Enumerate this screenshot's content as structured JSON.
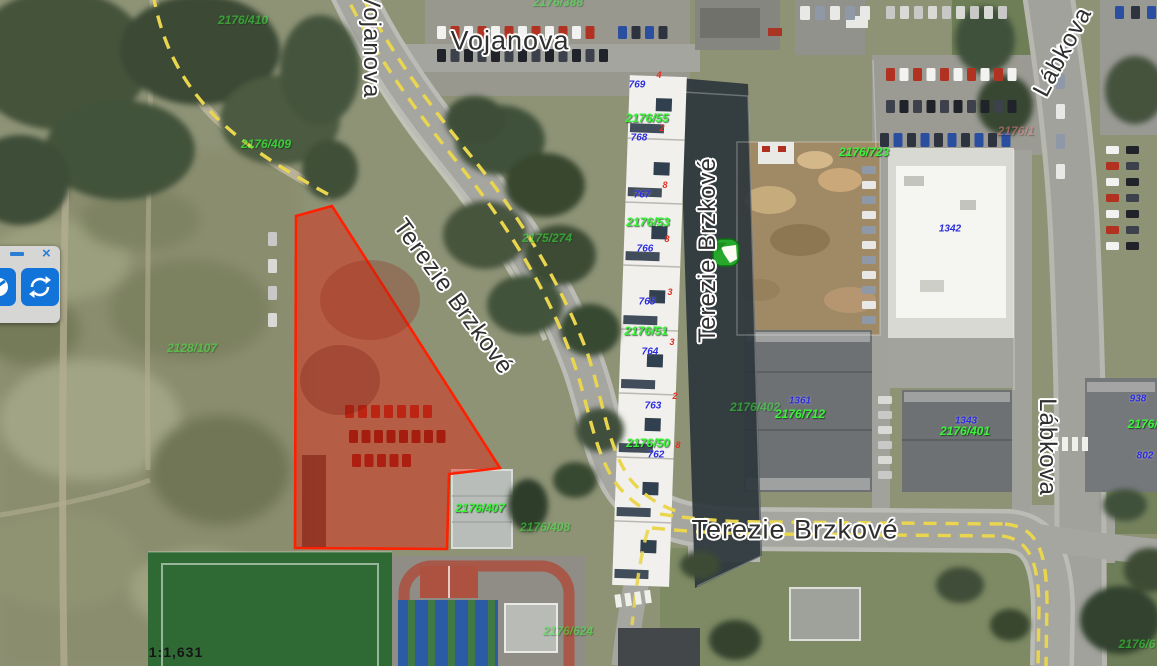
{
  "app": {
    "type": "aerial-map-viewer"
  },
  "colors": {
    "selection_red": "#ff2000",
    "parcel_green": "#3bf23b",
    "house_number_blue": "#2b2bdf",
    "orientation_red": "#e03024",
    "toolbar_blue": "#1273d8",
    "road_dash_yellow": "#ead64e",
    "marker_green": "#27a82c"
  },
  "toolbar": {
    "minimize_label": "–",
    "close_label": "×",
    "buttons": [
      {
        "name": "toolbar-button-partial",
        "icon": "partial-globe-icon"
      },
      {
        "name": "refresh-button",
        "icon": "refresh-icon"
      }
    ]
  },
  "marker": {
    "name": "map-marker",
    "x": 712,
    "y": 238
  },
  "map": {
    "scale_label": "1:1,631",
    "labels": [
      {
        "name": "street-label-vojanova-vertical",
        "text": "Vojanova",
        "x": 371,
        "y": 45,
        "rot": 90,
        "cls": "street"
      },
      {
        "name": "street-label-vojanova",
        "text": "Vojanova",
        "x": 510,
        "y": 41,
        "rot": 0,
        "cls": "street",
        "fs": 27
      },
      {
        "name": "street-label-terezie-brzkove-diagonal",
        "text": "Terezie Brzkové",
        "x": 453,
        "y": 297,
        "rot": 54,
        "cls": "street"
      },
      {
        "name": "street-label-terezie-brzkove-vertical",
        "text": "Terezie Brzkové",
        "x": 708,
        "y": 250,
        "rot": -90,
        "cls": "street"
      },
      {
        "name": "street-label-terezie-brzkove",
        "text": "Terezie Brzkové",
        "x": 795,
        "y": 530,
        "rot": 0,
        "cls": "street",
        "fs": 27
      },
      {
        "name": "street-label-labkova-top",
        "text": "Lábkova",
        "x": 1063,
        "y": 52,
        "rot": -62,
        "cls": "street"
      },
      {
        "name": "street-label-labkova",
        "text": "Lábkova",
        "x": 1047,
        "y": 447,
        "rot": 90,
        "cls": "street"
      },
      {
        "name": "parcel-label",
        "text": "2176/410",
        "x": 243,
        "y": 20,
        "cls": "parcel faint"
      },
      {
        "name": "parcel-label",
        "text": "2176/409",
        "x": 266,
        "y": 144,
        "cls": "parcel dim"
      },
      {
        "name": "parcel-label",
        "text": "2176/388",
        "x": 558,
        "y": 2,
        "cls": "parcel faint"
      },
      {
        "name": "parcel-label",
        "text": "2175/274",
        "x": 547,
        "y": 238,
        "cls": "parcel faint"
      },
      {
        "name": "parcel-label",
        "text": "2176/55",
        "x": 647,
        "y": 118,
        "cls": "parcel"
      },
      {
        "name": "parcel-label",
        "text": "2176/53",
        "x": 648,
        "y": 222,
        "cls": "parcel"
      },
      {
        "name": "parcel-label",
        "text": "2176/51",
        "x": 646,
        "y": 331,
        "cls": "parcel"
      },
      {
        "name": "parcel-label",
        "text": "2176/50",
        "x": 648,
        "y": 443,
        "cls": "parcel"
      },
      {
        "name": "parcel-label",
        "text": "2176/407",
        "x": 480,
        "y": 508,
        "cls": "parcel"
      },
      {
        "name": "parcel-label",
        "text": "2176/408",
        "x": 545,
        "y": 527,
        "cls": "parcel faint"
      },
      {
        "name": "parcel-label",
        "text": "2176/402",
        "x": 755,
        "y": 407,
        "cls": "parcel faint"
      },
      {
        "name": "parcel-label",
        "text": "2176/712",
        "x": 800,
        "y": 414,
        "cls": "parcel"
      },
      {
        "name": "parcel-label",
        "text": "2176/723",
        "x": 864,
        "y": 152,
        "cls": "parcel"
      },
      {
        "name": "parcel-label",
        "text": "2176/401",
        "x": 965,
        "y": 431,
        "cls": "parcel"
      },
      {
        "name": "parcel-label",
        "text": "2128/107",
        "x": 192,
        "y": 348,
        "cls": "parcel faint"
      },
      {
        "name": "parcel-label",
        "text": "2176/624",
        "x": 568,
        "y": 631,
        "cls": "parcel faint"
      },
      {
        "name": "parcel-label",
        "text": "2176/4",
        "x": 1146,
        "y": 424,
        "cls": "parcel"
      },
      {
        "name": "parcel-label",
        "text": "2176/6",
        "x": 1137,
        "y": 644,
        "cls": "parcel faint"
      },
      {
        "name": "parcel-label",
        "text": "2176/1",
        "x": 1016,
        "y": 131,
        "cls": "parcel pink faint"
      },
      {
        "name": "house-number",
        "text": "769",
        "x": 637,
        "y": 85,
        "cls": "house"
      },
      {
        "name": "house-number",
        "text": "768",
        "x": 639,
        "y": 138,
        "cls": "house"
      },
      {
        "name": "house-number",
        "text": "767",
        "x": 642,
        "y": 195,
        "cls": "house"
      },
      {
        "name": "house-number",
        "text": "766",
        "x": 645,
        "y": 249,
        "cls": "house"
      },
      {
        "name": "house-number",
        "text": "765",
        "x": 647,
        "y": 302,
        "cls": "house"
      },
      {
        "name": "house-number",
        "text": "764",
        "x": 650,
        "y": 352,
        "cls": "house"
      },
      {
        "name": "house-number",
        "text": "763",
        "x": 653,
        "y": 406,
        "cls": "house"
      },
      {
        "name": "house-number",
        "text": "762",
        "x": 656,
        "y": 455,
        "cls": "house"
      },
      {
        "name": "house-number",
        "text": "1361",
        "x": 800,
        "y": 401,
        "cls": "house"
      },
      {
        "name": "house-number",
        "text": "1343",
        "x": 966,
        "y": 421,
        "cls": "house"
      },
      {
        "name": "house-number",
        "text": "1342",
        "x": 950,
        "y": 229,
        "cls": "house"
      },
      {
        "name": "house-number",
        "text": "938",
        "x": 1138,
        "y": 399,
        "cls": "house"
      },
      {
        "name": "house-number",
        "text": "802",
        "x": 1145,
        "y": 456,
        "cls": "house"
      },
      {
        "name": "orientation-number",
        "text": "4",
        "x": 659,
        "y": 75,
        "cls": "orient"
      },
      {
        "name": "orientation-number",
        "text": "2",
        "x": 662,
        "y": 128,
        "cls": "orient"
      },
      {
        "name": "orientation-number",
        "text": "8",
        "x": 665,
        "y": 185,
        "cls": "orient"
      },
      {
        "name": "orientation-number",
        "text": "8",
        "x": 667,
        "y": 239,
        "cls": "orient"
      },
      {
        "name": "orientation-number",
        "text": "3",
        "x": 670,
        "y": 292,
        "cls": "orient"
      },
      {
        "name": "orientation-number",
        "text": "3",
        "x": 672,
        "y": 342,
        "cls": "orient"
      },
      {
        "name": "orientation-number",
        "text": "2",
        "x": 675,
        "y": 396,
        "cls": "orient"
      },
      {
        "name": "orientation-number",
        "text": "8",
        "x": 678,
        "y": 445,
        "cls": "orient"
      },
      {
        "name": "map-scale-label",
        "text": "1:1,631",
        "x": 176,
        "y": 652,
        "cls": "scale"
      }
    ]
  }
}
